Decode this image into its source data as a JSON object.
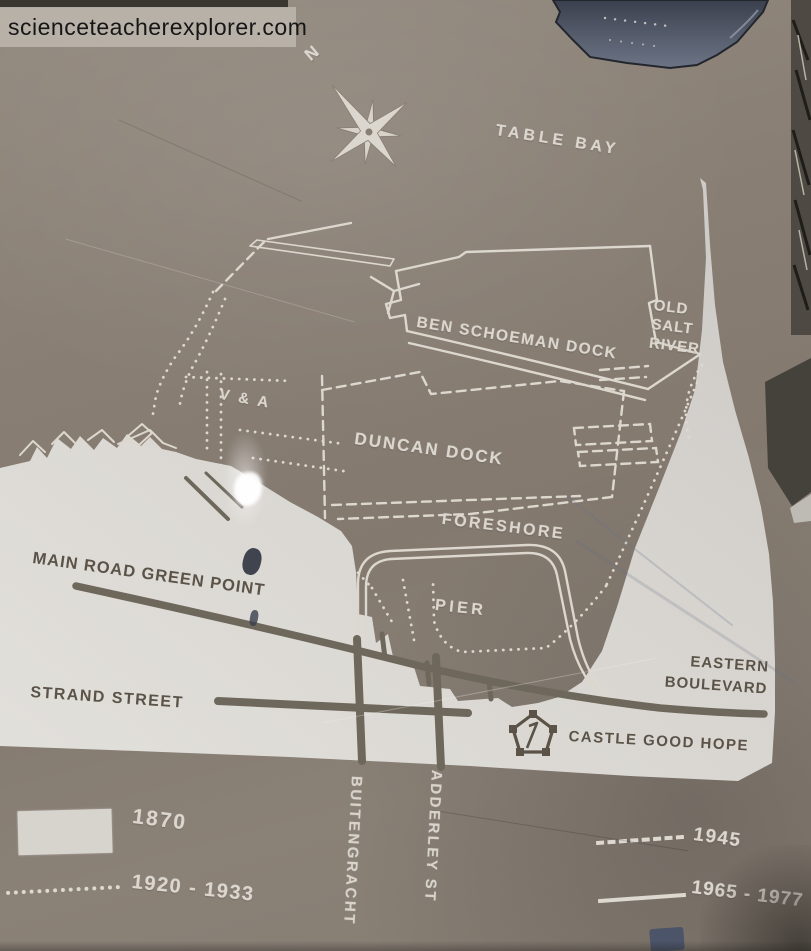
{
  "watermark": {
    "text": "scienceteacherexplorer.com"
  },
  "compass": {
    "north": "N"
  },
  "map": {
    "water_label": "TABLE BAY",
    "features": {
      "ben_schoeman_dock": "BEN SCHOEMAN DOCK",
      "old_salt_river_line1": "OLD",
      "old_salt_river_line2": "SALT",
      "old_salt_river_line3": "RIVER",
      "va": "V & A",
      "duncan_dock": "DUNCAN DOCK",
      "foreshore": "FORESHORE",
      "pier": "PIER",
      "castle": "CASTLE GOOD HOPE"
    },
    "roads": {
      "main_road": "MAIN ROAD GREEN POINT",
      "strand_street": "STRAND STREET",
      "eastern_boulevard_line1": "EASTERN",
      "eastern_boulevard_line2": "BOULEVARD",
      "buitengracht": "BUITENGRACHT",
      "adderley": "ADDERLEY ST"
    }
  },
  "legend": {
    "items": [
      {
        "sample": "solid-fill",
        "label": "1870"
      },
      {
        "sample": "dotted-line",
        "label": "1920 - 1933"
      },
      {
        "sample": "dashed-line",
        "label": "1945"
      },
      {
        "sample": "solid-line",
        "label": "1965 - 1977"
      }
    ]
  },
  "colors": {
    "stone": "#877e74",
    "engraved_line": "#dcd7ce",
    "land_fill": "#d8d5cf",
    "dark_text": "#5b5348",
    "puddle": "#454c59"
  }
}
